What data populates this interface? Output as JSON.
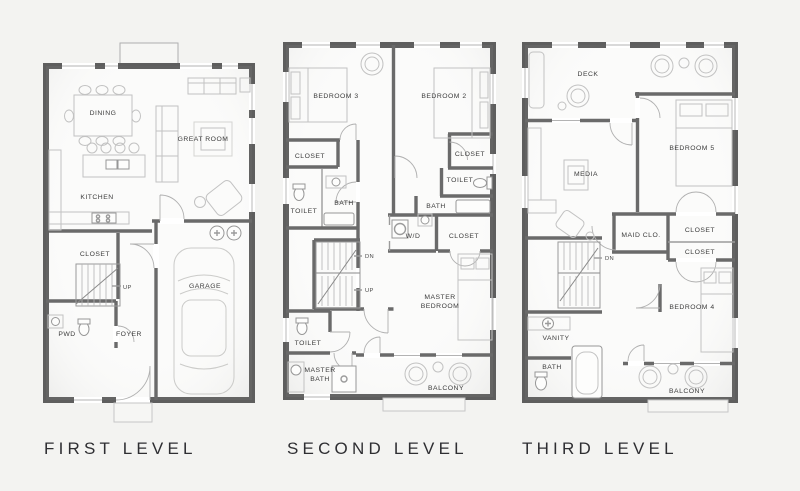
{
  "colors": {
    "background": "#f3f3f1",
    "floor": "#fbfbfa",
    "wall": "#5e5e5e",
    "interior_wall": "#6a6a6a",
    "furniture_line": "#c2c2c2",
    "fixture_line": "#979797",
    "label_text": "#3c3c3c",
    "title_text": "#2e2e32"
  },
  "plans": {
    "first": {
      "title": "FIRST LEVEL",
      "rooms": {
        "dining": "DINING",
        "great_room": "GREAT ROOM",
        "kitchen": "KITCHEN",
        "closet": "CLOSET",
        "up": "UP",
        "pwd": "PWD",
        "foyer": "FOYER",
        "garage": "GARAGE"
      }
    },
    "second": {
      "title": "SECOND LEVEL",
      "rooms": {
        "bedroom3": "BEDROOM 3",
        "bedroom2": "BEDROOM 2",
        "closet_left": "CLOSET",
        "closet_right": "CLOSET",
        "toilet_upper_left": "TOILET",
        "bath_left": "BATH",
        "toilet_upper_right": "TOILET",
        "bath_right": "BATH",
        "wd": "W/D",
        "closet_hall": "CLOSET",
        "dn": "DN",
        "up": "UP",
        "master_bedroom_line1": "MASTER",
        "master_bedroom_line2": "BEDROOM",
        "toilet_lower": "TOILET",
        "master_bath_line1": "MASTER",
        "master_bath_line2": "BATH",
        "balcony": "BALCONY"
      }
    },
    "third": {
      "title": "THIRD LEVEL",
      "rooms": {
        "deck": "DECK",
        "media": "MEDIA",
        "bedroom5": "BEDROOM 5",
        "maid_closet": "MAID CLO.",
        "closet_upper": "CLOSET",
        "closet_lower": "CLOSET",
        "dn": "DN",
        "vanity": "VANITY",
        "bath": "BATH",
        "bedroom4": "BEDROOM 4",
        "balcony": "BALCONY"
      }
    }
  }
}
